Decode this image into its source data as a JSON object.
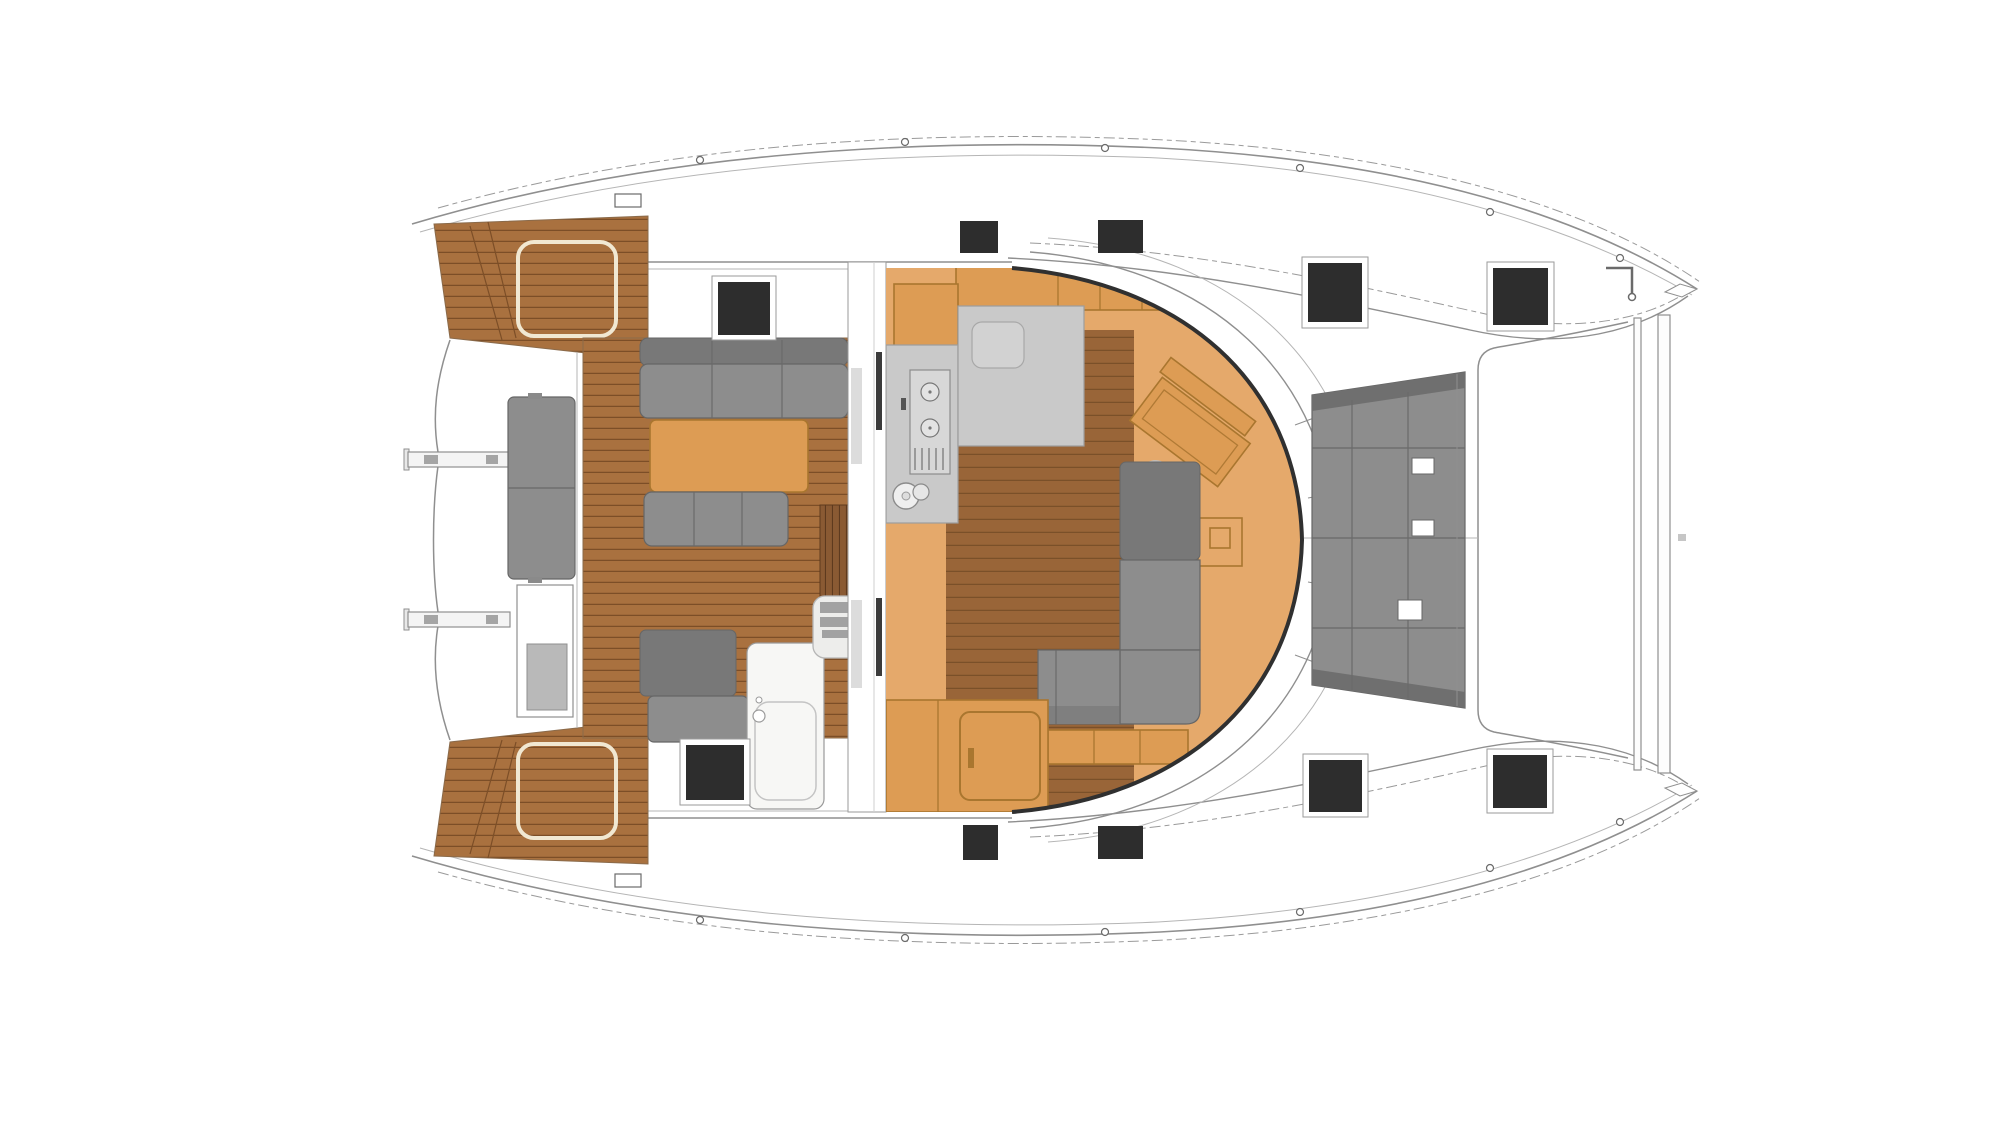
{
  "drawing": {
    "subject": "catamaran-deck-plan-top-view",
    "visible_text": [],
    "orientation": "bow-right-stern-left"
  },
  "palette": {
    "bg": "#ffffff",
    "line": "#8f8f8f",
    "line_dark": "#303030",
    "teak": "#a9713f",
    "teak_line": "#7c4e27",
    "wood": "#996538",
    "wood_line": "#7a5029",
    "steps": "#8a5a33",
    "steps_line": "#5e3a1e",
    "saloon_floor": "#e5a96b",
    "furn_orange": "#dd9c54",
    "furn_orange_dark": "#a9762f",
    "sofa": "#8d8d8d",
    "sofa_dark": "#787878",
    "sofa_outline": "#666666",
    "counter": "#c9c9c9",
    "counter_dark": "#9d9d9d",
    "hatch": "#2d2d2d",
    "white_fix": "#f7f7f5"
  },
  "deck_hatches": {
    "count": 10,
    "color": "#2d2d2d"
  }
}
